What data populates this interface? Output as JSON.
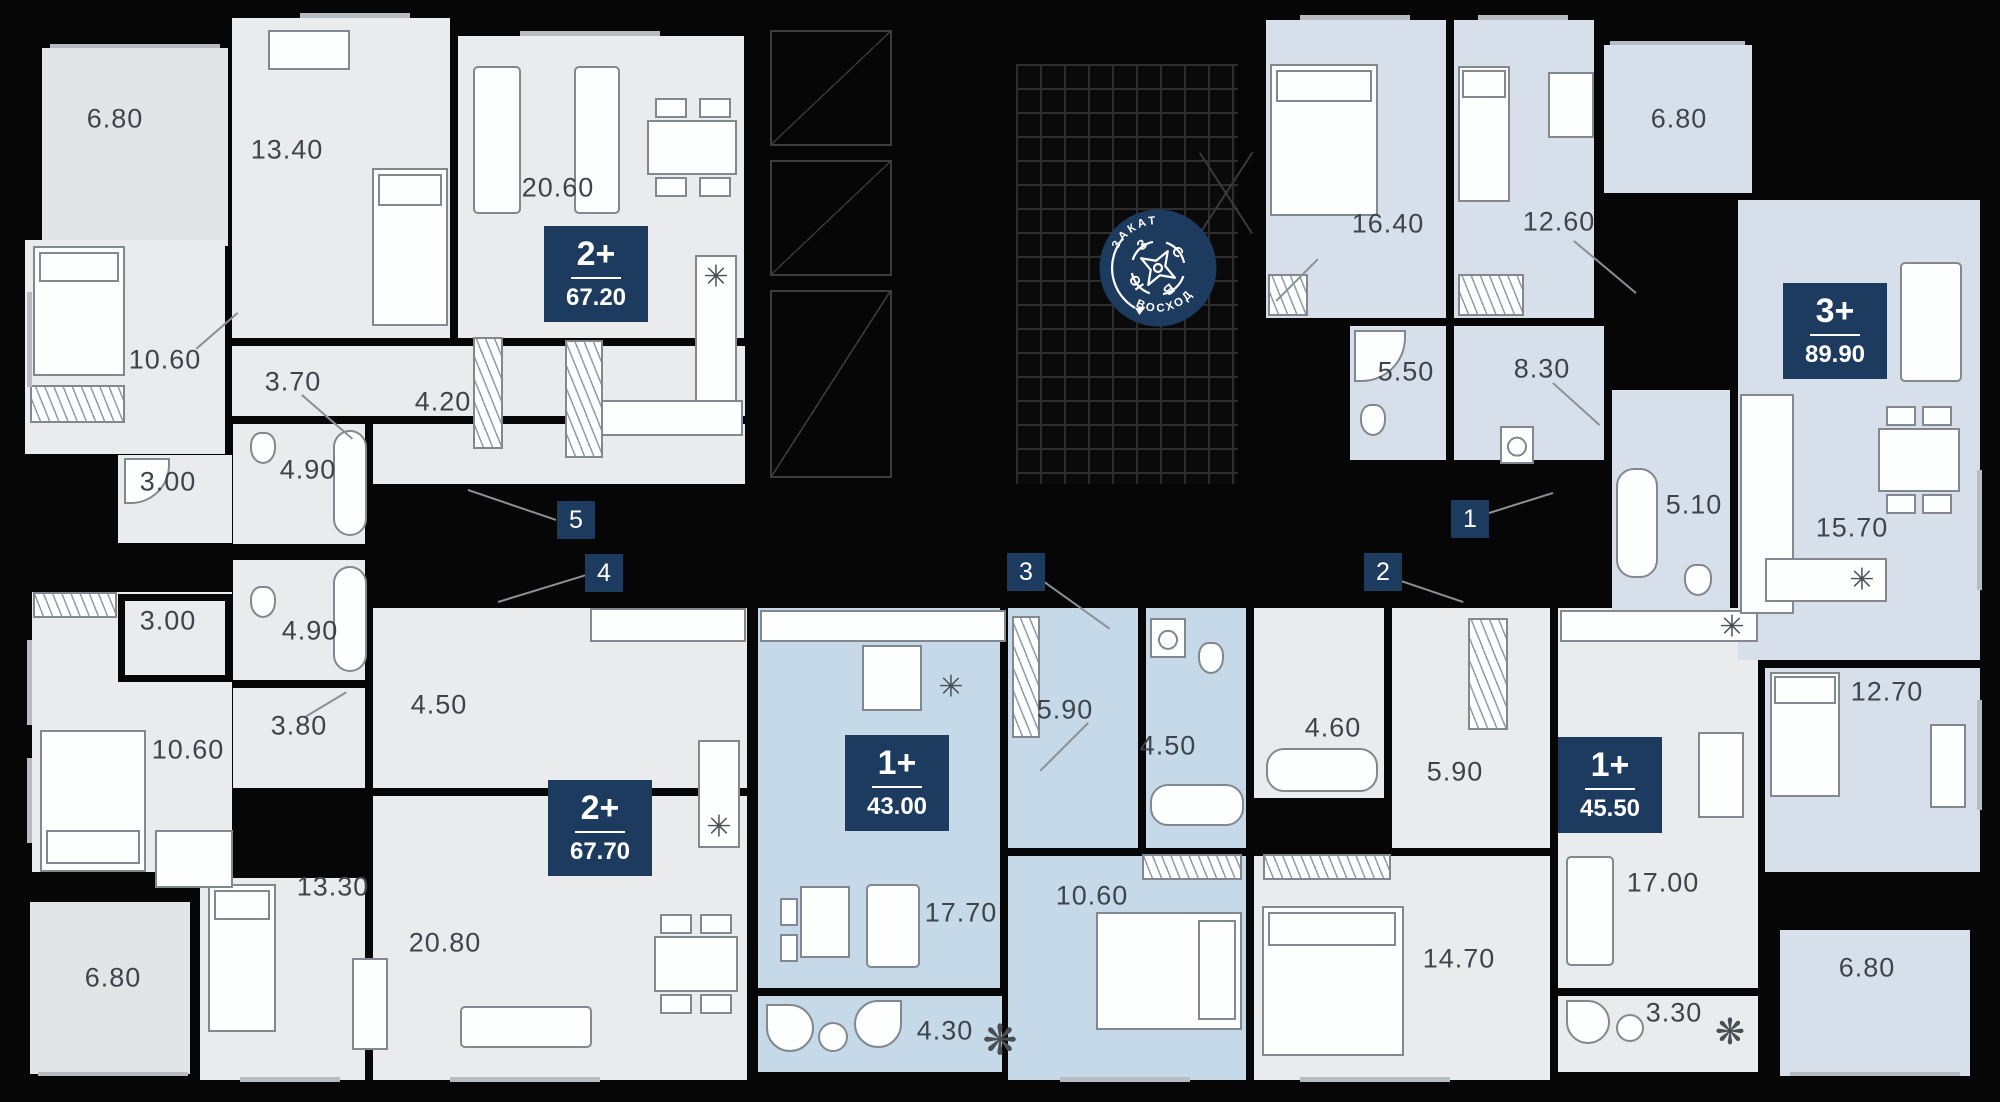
{
  "project": {
    "logo_top": "ЗАКАТ",
    "logo_bottom": "ВОСХОД"
  },
  "compass": {
    "n": "С",
    "e": "В",
    "s": "Ю",
    "w": "З"
  },
  "icons": {
    "fridge": "✳",
    "plant": "❋"
  },
  "markers": [
    "1",
    "2",
    "3",
    "4",
    "5"
  ],
  "apartments": [
    {
      "id": "apt-1",
      "type_label": "3+",
      "area_value": "89.90",
      "marker": "1",
      "highlighted": false,
      "rooms": {
        "bedroom1": "16.40",
        "bedroom2": "12.60",
        "balcony1": "6.80",
        "bath1": "5.50",
        "hall": "8.30",
        "bath2": "5.10",
        "kitchen_living": "15.70",
        "bedroom3": "12.70",
        "balcony2": "6.80"
      }
    },
    {
      "id": "apt-2",
      "type_label": "1+",
      "area_value": "45.50",
      "marker": "2",
      "highlighted": false,
      "rooms": {
        "bath": "4.60",
        "hall": "5.90",
        "bedroom": "14.70",
        "kitchen_living": "17.00",
        "balcony": "3.30"
      }
    },
    {
      "id": "apt-3",
      "type_label": "1+",
      "area_value": "43.00",
      "marker": "3",
      "highlighted": true,
      "rooms": {
        "hall": "5.90",
        "bath": "4.50",
        "kitchen_living": "17.70",
        "bedroom": "10.60",
        "balcony": "4.30"
      }
    },
    {
      "id": "apt-4",
      "type_label": "2+",
      "area_value": "67.70",
      "marker": "4",
      "highlighted": false,
      "rooms": {
        "bath1": "3.00",
        "bath2": "4.90",
        "bedroom1": "10.60",
        "hall1": "3.80",
        "hall2": "4.50",
        "bedroom2": "13.30",
        "kitchen_living": "20.80",
        "balcony": "6.80"
      }
    },
    {
      "id": "apt-5",
      "type_label": "2+",
      "area_value": "67.20",
      "marker": "5",
      "highlighted": false,
      "rooms": {
        "balcony": "6.80",
        "bedroom1": "13.40",
        "kitchen_living": "20.60",
        "bedroom2": "10.60",
        "hall1": "3.70",
        "hall2": "4.20",
        "bath1": "3.00",
        "bath2": "4.90"
      }
    }
  ],
  "colors": {
    "floor_gray": "#eaebec",
    "floor_highlight": "#c5d9e8",
    "floor_pale": "#d7e0ea",
    "badge_navy": "#1d3b5e",
    "wall_black": "#060606"
  }
}
